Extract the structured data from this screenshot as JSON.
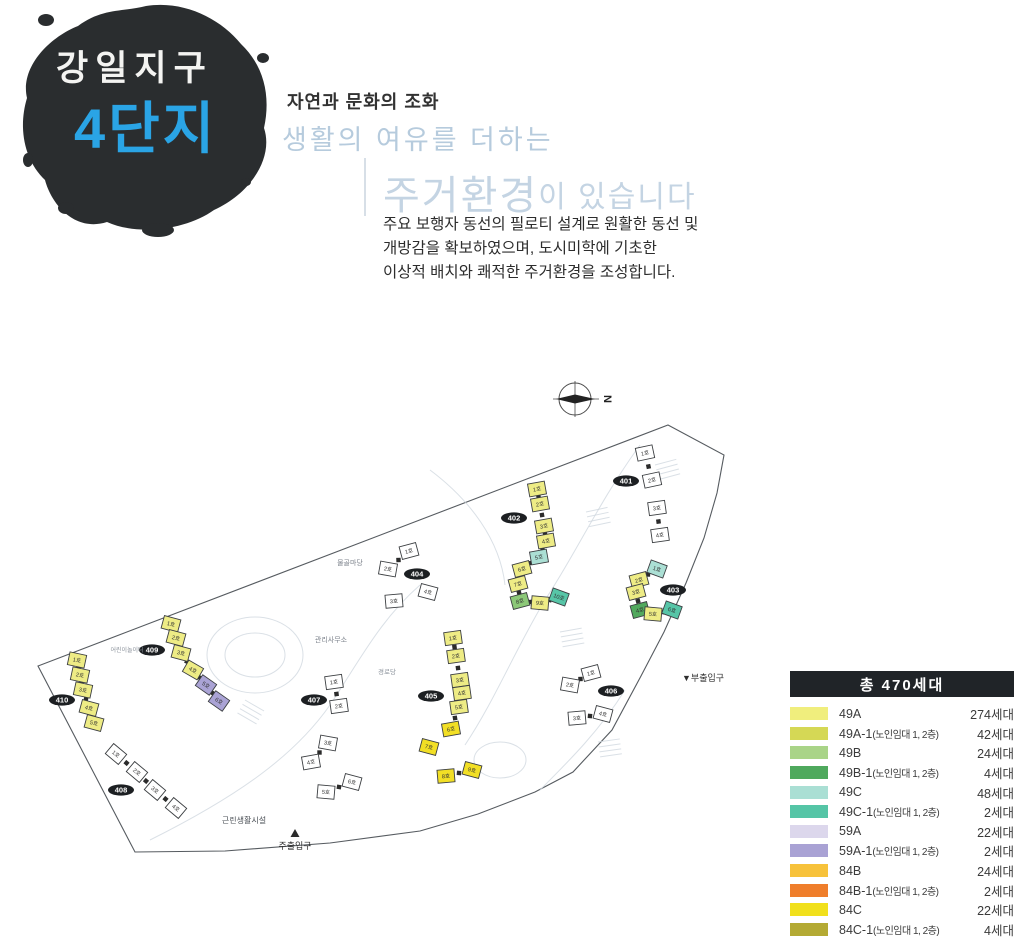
{
  "header": {
    "district": "강일지구",
    "complex": "4단지",
    "tagline": "자연과 문화의 조화",
    "subtitle": "생활의 여유를 더하는",
    "headline_main": "주거환경",
    "headline_rest": "이 있습니다",
    "description_lines": [
      "주요 보행자 동선의 필로티 설계로 원활한 동선 및",
      "개방감을 확보하였으며, 도시미학에 기초한",
      "이상적 배치와 쾌적한 주거환경을 조성합니다."
    ],
    "accent_blue": "#2aa4e5",
    "light_blue": "#c4d4e3",
    "ink_color": "#2a2d2f"
  },
  "legend": {
    "title": "총  470세대",
    "items": [
      {
        "type": "49A",
        "note": "",
        "count": "274세대",
        "color": "#f0ee7d"
      },
      {
        "type": "49A-1",
        "note": "(노인임대 1, 2층)",
        "count": "42세대",
        "color": "#d5d855"
      },
      {
        "type": "49B",
        "note": "",
        "count": "24세대",
        "color": "#a9d488"
      },
      {
        "type": "49B-1",
        "note": "(노인임대 1, 2층)",
        "count": "4세대",
        "color": "#4fa95d"
      },
      {
        "type": "49C",
        "note": "",
        "count": "48세대",
        "color": "#aadfd4"
      },
      {
        "type": "49C-1",
        "note": "(노인임대 1, 2층)",
        "count": "2세대",
        "color": "#55c5a6"
      },
      {
        "type": "59A",
        "note": "",
        "count": "22세대",
        "color": "#dcd7ec"
      },
      {
        "type": "59A-1",
        "note": "(노인임대 1, 2층)",
        "count": "2세대",
        "color": "#a9a2d4"
      },
      {
        "type": "84B",
        "note": "",
        "count": "24세대",
        "color": "#f7c23b"
      },
      {
        "type": "84B-1",
        "note": "(노인임대 1, 2층)",
        "count": "2세대",
        "color": "#ef7e2b"
      },
      {
        "type": "84C",
        "note": "",
        "count": "22세대",
        "color": "#f1e01c"
      },
      {
        "type": "84C-1",
        "note": "(노인임대 1, 2층)",
        "count": "4세대",
        "color": "#b4aa34"
      }
    ]
  },
  "map": {
    "compass_label": "N",
    "boundary": [
      [
        668,
        425
      ],
      [
        724,
        455
      ],
      [
        717,
        493
      ],
      [
        704,
        538
      ],
      [
        686,
        583
      ],
      [
        664,
        632
      ],
      [
        641,
        676
      ],
      [
        612,
        730
      ],
      [
        573,
        772
      ],
      [
        535,
        792
      ],
      [
        478,
        814
      ],
      [
        420,
        831
      ],
      [
        330,
        843
      ],
      [
        225,
        851
      ],
      [
        135,
        852
      ],
      [
        38,
        666
      ]
    ],
    "unit_fills": {
      "W": "#ffffff",
      "A": "#eeec85",
      "Y": "#f2df25",
      "C": "#abdfd4",
      "C1": "#57c5a7",
      "B": "#8cc878",
      "B1": "#52a95e",
      "L": "#aaa3d5"
    },
    "labels": [
      {
        "t": "물골마당",
        "x": 350,
        "y": 565,
        "s": 7,
        "c": "#7d838c"
      },
      {
        "t": "관리사무소",
        "x": 331,
        "y": 642,
        "s": 7,
        "c": "#7d838c"
      },
      {
        "t": "경로당",
        "x": 387,
        "y": 674,
        "s": 6.5,
        "c": "#8a919a"
      },
      {
        "t": "어린이놀이터",
        "x": 127,
        "y": 652,
        "s": 6,
        "c": "#8a919a"
      },
      {
        "t": "근린생활시설",
        "x": 244,
        "y": 823,
        "s": 8,
        "c": "#4a4f55"
      }
    ],
    "entrances": {
      "main": {
        "label": "주출입구",
        "x": 295,
        "y": 849,
        "marker": "▲"
      },
      "sub": {
        "label": "▼부출입구",
        "x": 682,
        "y": 681
      }
    },
    "buildings": [
      {
        "id": "401",
        "lx": 626,
        "ly": 481,
        "units": [
          {
            "n": "1호",
            "x": 645,
            "y": 453,
            "a": -12,
            "c": "W"
          },
          {
            "n": "2호",
            "x": 652,
            "y": 480,
            "a": -12,
            "c": "W"
          },
          {
            "n": "3호",
            "x": 657,
            "y": 508,
            "a": -8,
            "c": "W"
          },
          {
            "n": "4호",
            "x": 660,
            "y": 535,
            "a": -8,
            "c": "W"
          }
        ]
      },
      {
        "id": "402",
        "lx": 514,
        "ly": 518,
        "units": [
          {
            "n": "1호",
            "x": 537,
            "y": 489,
            "a": -10,
            "c": "A"
          },
          {
            "n": "2호",
            "x": 540,
            "y": 504,
            "a": -10,
            "c": "A"
          },
          {
            "n": "3호",
            "x": 544,
            "y": 526,
            "a": -10,
            "c": "A"
          },
          {
            "n": "4호",
            "x": 546,
            "y": 541,
            "a": -10,
            "c": "A"
          },
          {
            "n": "5호",
            "x": 539,
            "y": 557,
            "a": -10,
            "c": "C"
          },
          {
            "n": "6호",
            "x": 522,
            "y": 569,
            "a": -15,
            "c": "A"
          },
          {
            "n": "7호",
            "x": 518,
            "y": 584,
            "a": -15,
            "c": "A"
          },
          {
            "n": "8호",
            "x": 520,
            "y": 601,
            "a": -15,
            "c": "B"
          },
          {
            "n": "9호",
            "x": 540,
            "y": 603,
            "a": 5,
            "c": "A"
          },
          {
            "n": "10호",
            "x": 559,
            "y": 597,
            "a": 20,
            "c": "C1"
          }
        ]
      },
      {
        "id": "403",
        "lx": 673,
        "ly": 590,
        "units": [
          {
            "n": "1호",
            "x": 657,
            "y": 569,
            "a": 20,
            "c": "C"
          },
          {
            "n": "2호",
            "x": 639,
            "y": 580,
            "a": -15,
            "c": "A"
          },
          {
            "n": "3호",
            "x": 636,
            "y": 592,
            "a": -15,
            "c": "A"
          },
          {
            "n": "4호",
            "x": 640,
            "y": 610,
            "a": -15,
            "c": "B1"
          },
          {
            "n": "5호",
            "x": 653,
            "y": 614,
            "a": 5,
            "c": "A"
          },
          {
            "n": "6호",
            "x": 672,
            "y": 610,
            "a": 20,
            "c": "C1"
          }
        ]
      },
      {
        "id": "404",
        "lx": 417,
        "ly": 574,
        "units": [
          {
            "n": "1호",
            "x": 409,
            "y": 551,
            "a": -15,
            "c": "W"
          },
          {
            "n": "2호",
            "x": 388,
            "y": 569,
            "a": 10,
            "c": "W"
          },
          {
            "n": "3호",
            "x": 394,
            "y": 601,
            "a": -5,
            "c": "W"
          },
          {
            "n": "4호",
            "x": 428,
            "y": 592,
            "a": 15,
            "c": "W"
          }
        ]
      },
      {
        "id": "405",
        "lx": 431,
        "ly": 696,
        "units": [
          {
            "n": "1호",
            "x": 453,
            "y": 638,
            "a": -8,
            "c": "A"
          },
          {
            "n": "2호",
            "x": 456,
            "y": 656,
            "a": -8,
            "c": "A"
          },
          {
            "n": "3호",
            "x": 460,
            "y": 680,
            "a": -8,
            "c": "A"
          },
          {
            "n": "4호",
            "x": 462,
            "y": 693,
            "a": -8,
            "c": "A"
          },
          {
            "n": "5호",
            "x": 459,
            "y": 707,
            "a": -8,
            "c": "A"
          },
          {
            "n": "6호",
            "x": 451,
            "y": 729,
            "a": -10,
            "c": "Y"
          },
          {
            "n": "7호",
            "x": 429,
            "y": 747,
            "a": 15,
            "c": "Y"
          },
          {
            "n": "8호",
            "x": 446,
            "y": 776,
            "a": -5,
            "c": "Y"
          },
          {
            "n": "9호",
            "x": 472,
            "y": 770,
            "a": 15,
            "c": "Y"
          }
        ]
      },
      {
        "id": "406",
        "lx": 611,
        "ly": 691,
        "units": [
          {
            "n": "1호",
            "x": 591,
            "y": 673,
            "a": -15,
            "c": "W"
          },
          {
            "n": "2호",
            "x": 570,
            "y": 685,
            "a": 10,
            "c": "W"
          },
          {
            "n": "3호",
            "x": 577,
            "y": 718,
            "a": -5,
            "c": "W"
          },
          {
            "n": "4호",
            "x": 603,
            "y": 714,
            "a": 15,
            "c": "W"
          }
        ]
      },
      {
        "id": "407",
        "lx": 314,
        "ly": 700,
        "units": [
          {
            "n": "1호",
            "x": 334,
            "y": 682,
            "a": -8,
            "c": "W"
          },
          {
            "n": "2호",
            "x": 339,
            "y": 706,
            "a": -8,
            "c": "W"
          },
          {
            "n": "3호",
            "x": 328,
            "y": 743,
            "a": 10,
            "c": "W"
          },
          {
            "n": "4호",
            "x": 311,
            "y": 762,
            "a": -10,
            "c": "W"
          },
          {
            "n": "5호",
            "x": 326,
            "y": 792,
            "a": 5,
            "c": "W"
          },
          {
            "n": "6호",
            "x": 352,
            "y": 782,
            "a": 15,
            "c": "W"
          }
        ]
      },
      {
        "id": "408",
        "lx": 121,
        "ly": 790,
        "units": [
          {
            "n": "1호",
            "x": 116,
            "y": 754,
            "a": 40,
            "c": "W"
          },
          {
            "n": "2호",
            "x": 137,
            "y": 772,
            "a": 40,
            "c": "W"
          },
          {
            "n": "3호",
            "x": 155,
            "y": 790,
            "a": 40,
            "c": "W"
          },
          {
            "n": "4호",
            "x": 176,
            "y": 808,
            "a": 40,
            "c": "W"
          }
        ]
      },
      {
        "id": "409",
        "lx": 152,
        "ly": 650,
        "units": [
          {
            "n": "1호",
            "x": 171,
            "y": 624,
            "a": 15,
            "c": "A"
          },
          {
            "n": "2호",
            "x": 176,
            "y": 638,
            "a": 15,
            "c": "A"
          },
          {
            "n": "3호",
            "x": 181,
            "y": 653,
            "a": 15,
            "c": "A"
          },
          {
            "n": "4호",
            "x": 193,
            "y": 670,
            "a": 30,
            "c": "A"
          },
          {
            "n": "5호",
            "x": 206,
            "y": 685,
            "a": 35,
            "c": "L"
          },
          {
            "n": "6호",
            "x": 219,
            "y": 701,
            "a": 35,
            "c": "L"
          }
        ]
      },
      {
        "id": "410",
        "lx": 62,
        "ly": 700,
        "units": [
          {
            "n": "1호",
            "x": 77,
            "y": 660,
            "a": 12,
            "c": "A"
          },
          {
            "n": "2호",
            "x": 80,
            "y": 675,
            "a": 12,
            "c": "A"
          },
          {
            "n": "3호",
            "x": 83,
            "y": 690,
            "a": 12,
            "c": "A"
          },
          {
            "n": "4호",
            "x": 89,
            "y": 708,
            "a": 15,
            "c": "A"
          },
          {
            "n": "5호",
            "x": 94,
            "y": 723,
            "a": 15,
            "c": "A"
          }
        ]
      }
    ]
  }
}
